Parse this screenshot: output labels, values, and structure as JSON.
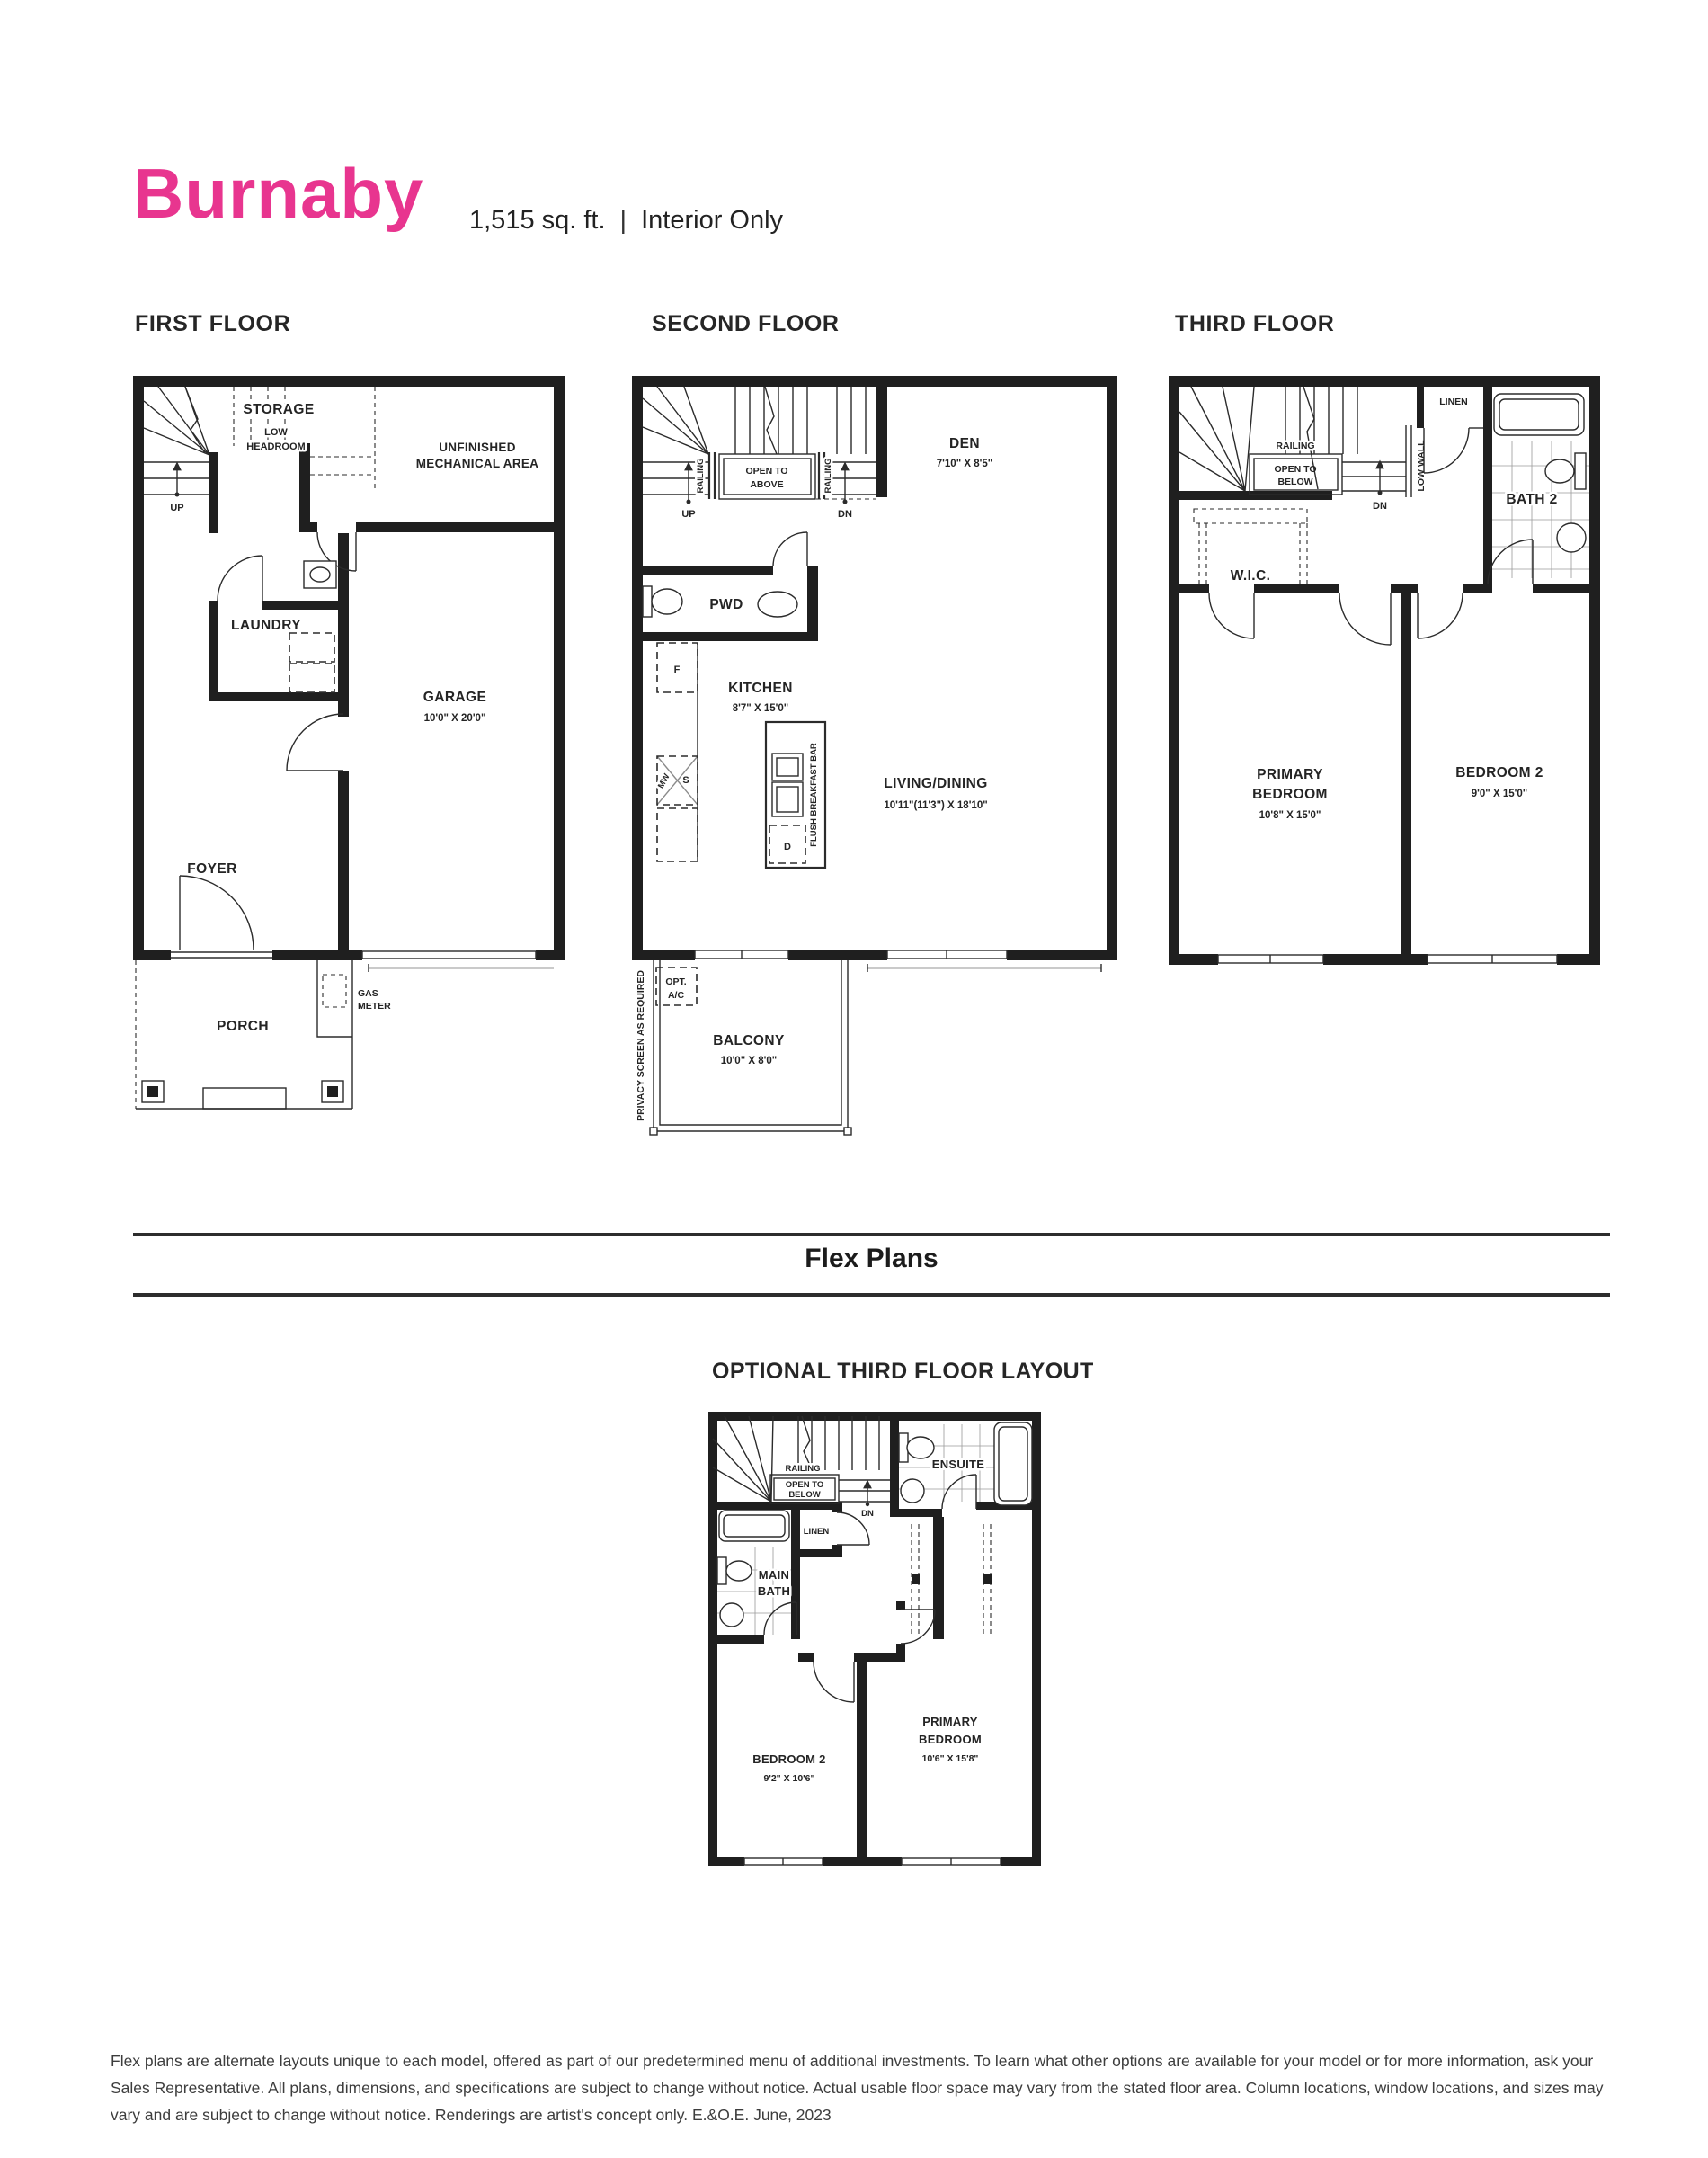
{
  "header": {
    "model_name": "Burnaby",
    "sqft": "1,515 sq. ft.",
    "separator": "|",
    "plan_type": "Interior Only"
  },
  "colors": {
    "brand_pink": "#E8358F",
    "ink": "#1f1f1f"
  },
  "first_floor": {
    "heading": "FIRST FLOOR",
    "labels": {
      "storage": "STORAGE",
      "low_headroom_line1": "LOW",
      "low_headroom_line2": "HEADROOM",
      "mechanical_line1": "UNFINISHED",
      "mechanical_line2": "MECHANICAL AREA",
      "up": "UP",
      "laundry": "LAUNDRY",
      "garage": "GARAGE",
      "garage_dims": "10'0\" X 20'0\"",
      "foyer": "FOYER",
      "porch": "PORCH",
      "gas_meter_line1": "GAS",
      "gas_meter_line2": "METER"
    }
  },
  "second_floor": {
    "heading": "SECOND FLOOR",
    "labels": {
      "railing_left": "RAILING",
      "railing_right": "RAILING",
      "open_to_above_line1": "OPEN TO",
      "open_to_above_line2": "ABOVE",
      "up": "UP",
      "dn": "DN",
      "den": "DEN",
      "den_dims": "7'10\" X 8'5\"",
      "pwd": "PWD",
      "kitchen": "KITCHEN",
      "kitchen_dims": "8'7\" X 15'0\"",
      "fridge": "F",
      "microwave": "MW",
      "stove": "S",
      "dishwasher": "D",
      "flush_breakfast_bar": "FLUSH BREAKFAST BAR",
      "living_dining": "LIVING/DINING",
      "living_dining_dims": "10'11\"(11'3\") X 18'10\"",
      "opt_ac_line1": "OPT.",
      "opt_ac_line2": "A/C",
      "balcony": "BALCONY",
      "balcony_dims": "10'0\" X 8'0\"",
      "privacy_screen": "PRIVACY SCREEN AS REQUIRED"
    }
  },
  "third_floor": {
    "heading": "THIRD FLOOR",
    "labels": {
      "railing": "RAILING",
      "open_to_below_line1": "OPEN TO",
      "open_to_below_line2": "BELOW",
      "dn": "DN",
      "linen": "LINEN",
      "low_wall": "LOW WALL",
      "bath2": "BATH 2",
      "wic": "W.I.C.",
      "primary_line1": "PRIMARY",
      "primary_line2": "BEDROOM",
      "primary_dims": "10'8\" X 15'0\"",
      "bedroom2": "BEDROOM 2",
      "bedroom2_dims": "9'0\" X 15'0\""
    }
  },
  "flex_plans": {
    "heading": "Flex Plans",
    "optional_layout": {
      "heading": "OPTIONAL THIRD FLOOR LAYOUT",
      "labels": {
        "railing": "RAILING",
        "open_to_below_line1": "OPEN TO",
        "open_to_below_line2": "BELOW",
        "dn": "DN",
        "ensuite": "ENSUITE",
        "linen": "LINEN",
        "main_bath_line1": "MAIN",
        "main_bath_line2": "BATH",
        "bedroom2": "BEDROOM 2",
        "bedroom2_dims": "9'2\" X 10'6\"",
        "primary_line1": "PRIMARY",
        "primary_line2": "BEDROOM",
        "primary_dims": "10'6\" X 15'8\""
      }
    }
  },
  "footer": {
    "line1": "Flex plans are alternate layouts unique to each model, offered as part of our predetermined menu of additional investments. To learn what other options are available for your model or for more information, ask your",
    "line2": "Sales Representative. All plans, dimensions, and specifications are subject to change without notice. Actual usable floor space may vary from the stated floor area. Column locations, window locations, and sizes may",
    "line3": "vary and are subject to change without notice. Renderings are artist's concept only. E.&O.E. June, 2023"
  }
}
